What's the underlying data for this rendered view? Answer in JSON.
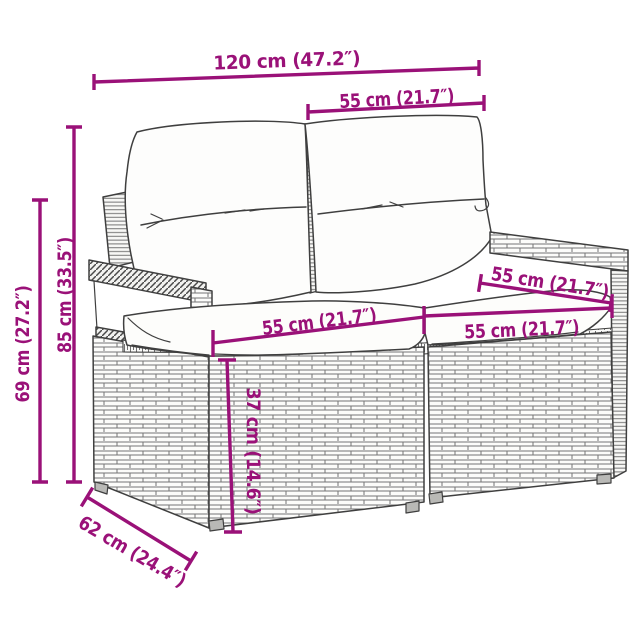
{
  "diagram": {
    "kind": "product-dimension-diagram",
    "subject": "poly rattan 2-seater garden sofa with back and seat cushions",
    "background_color": "#ffffff",
    "accent_color": "#9a1178",
    "outline_color": "#3f3f3f"
  },
  "dims": {
    "width_total": {
      "label": "120 cm (47.2″)"
    },
    "back_width": {
      "label": "55 cm (21.7″)"
    },
    "height_total": {
      "label": "85 cm (33.5″)"
    },
    "height_armrest": {
      "label": "69 cm (27.2″)"
    },
    "seat_width_left": {
      "label": "55 cm (21.7″)"
    },
    "seat_width_right": {
      "label": "55 cm (21.7″)"
    },
    "seat_depth": {
      "label": "55 cm (21.7″)"
    },
    "seat_height": {
      "label": "37 cm (14.6″)"
    },
    "depth_total": {
      "label": "62 cm (24.4″)"
    }
  }
}
